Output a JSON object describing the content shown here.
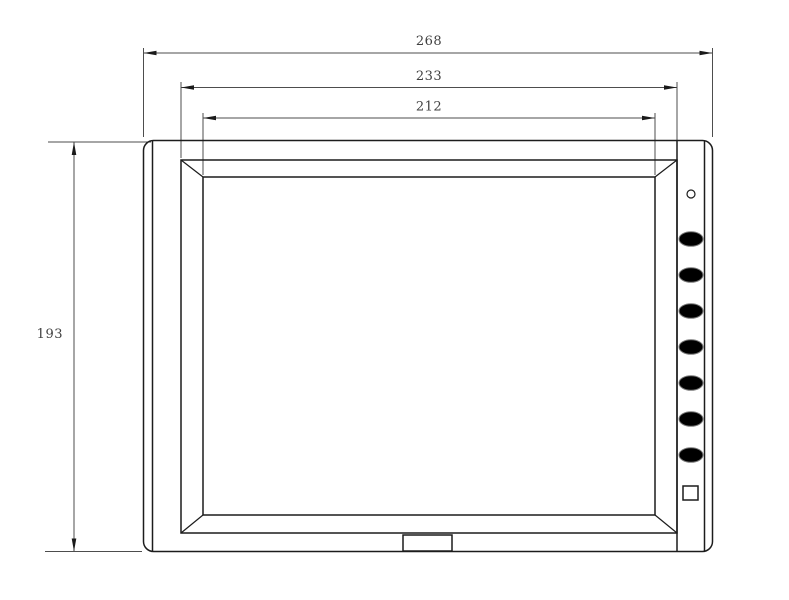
{
  "page": {
    "background": "#ffffff",
    "kind": "technical dimension drawing, monitor front view"
  },
  "drawing": {
    "line_color": "#1c1c1c",
    "dimension_line_color": "#4d4d4d",
    "dimension_text_color": "#3f3f3f",
    "dimensions": {
      "overall_width": "268",
      "frame_width": "233",
      "screen_width": "212",
      "overall_height": "193"
    },
    "controls": {
      "power_led_count": 1,
      "oval_button_count": 7,
      "square_button_count": 1
    }
  }
}
